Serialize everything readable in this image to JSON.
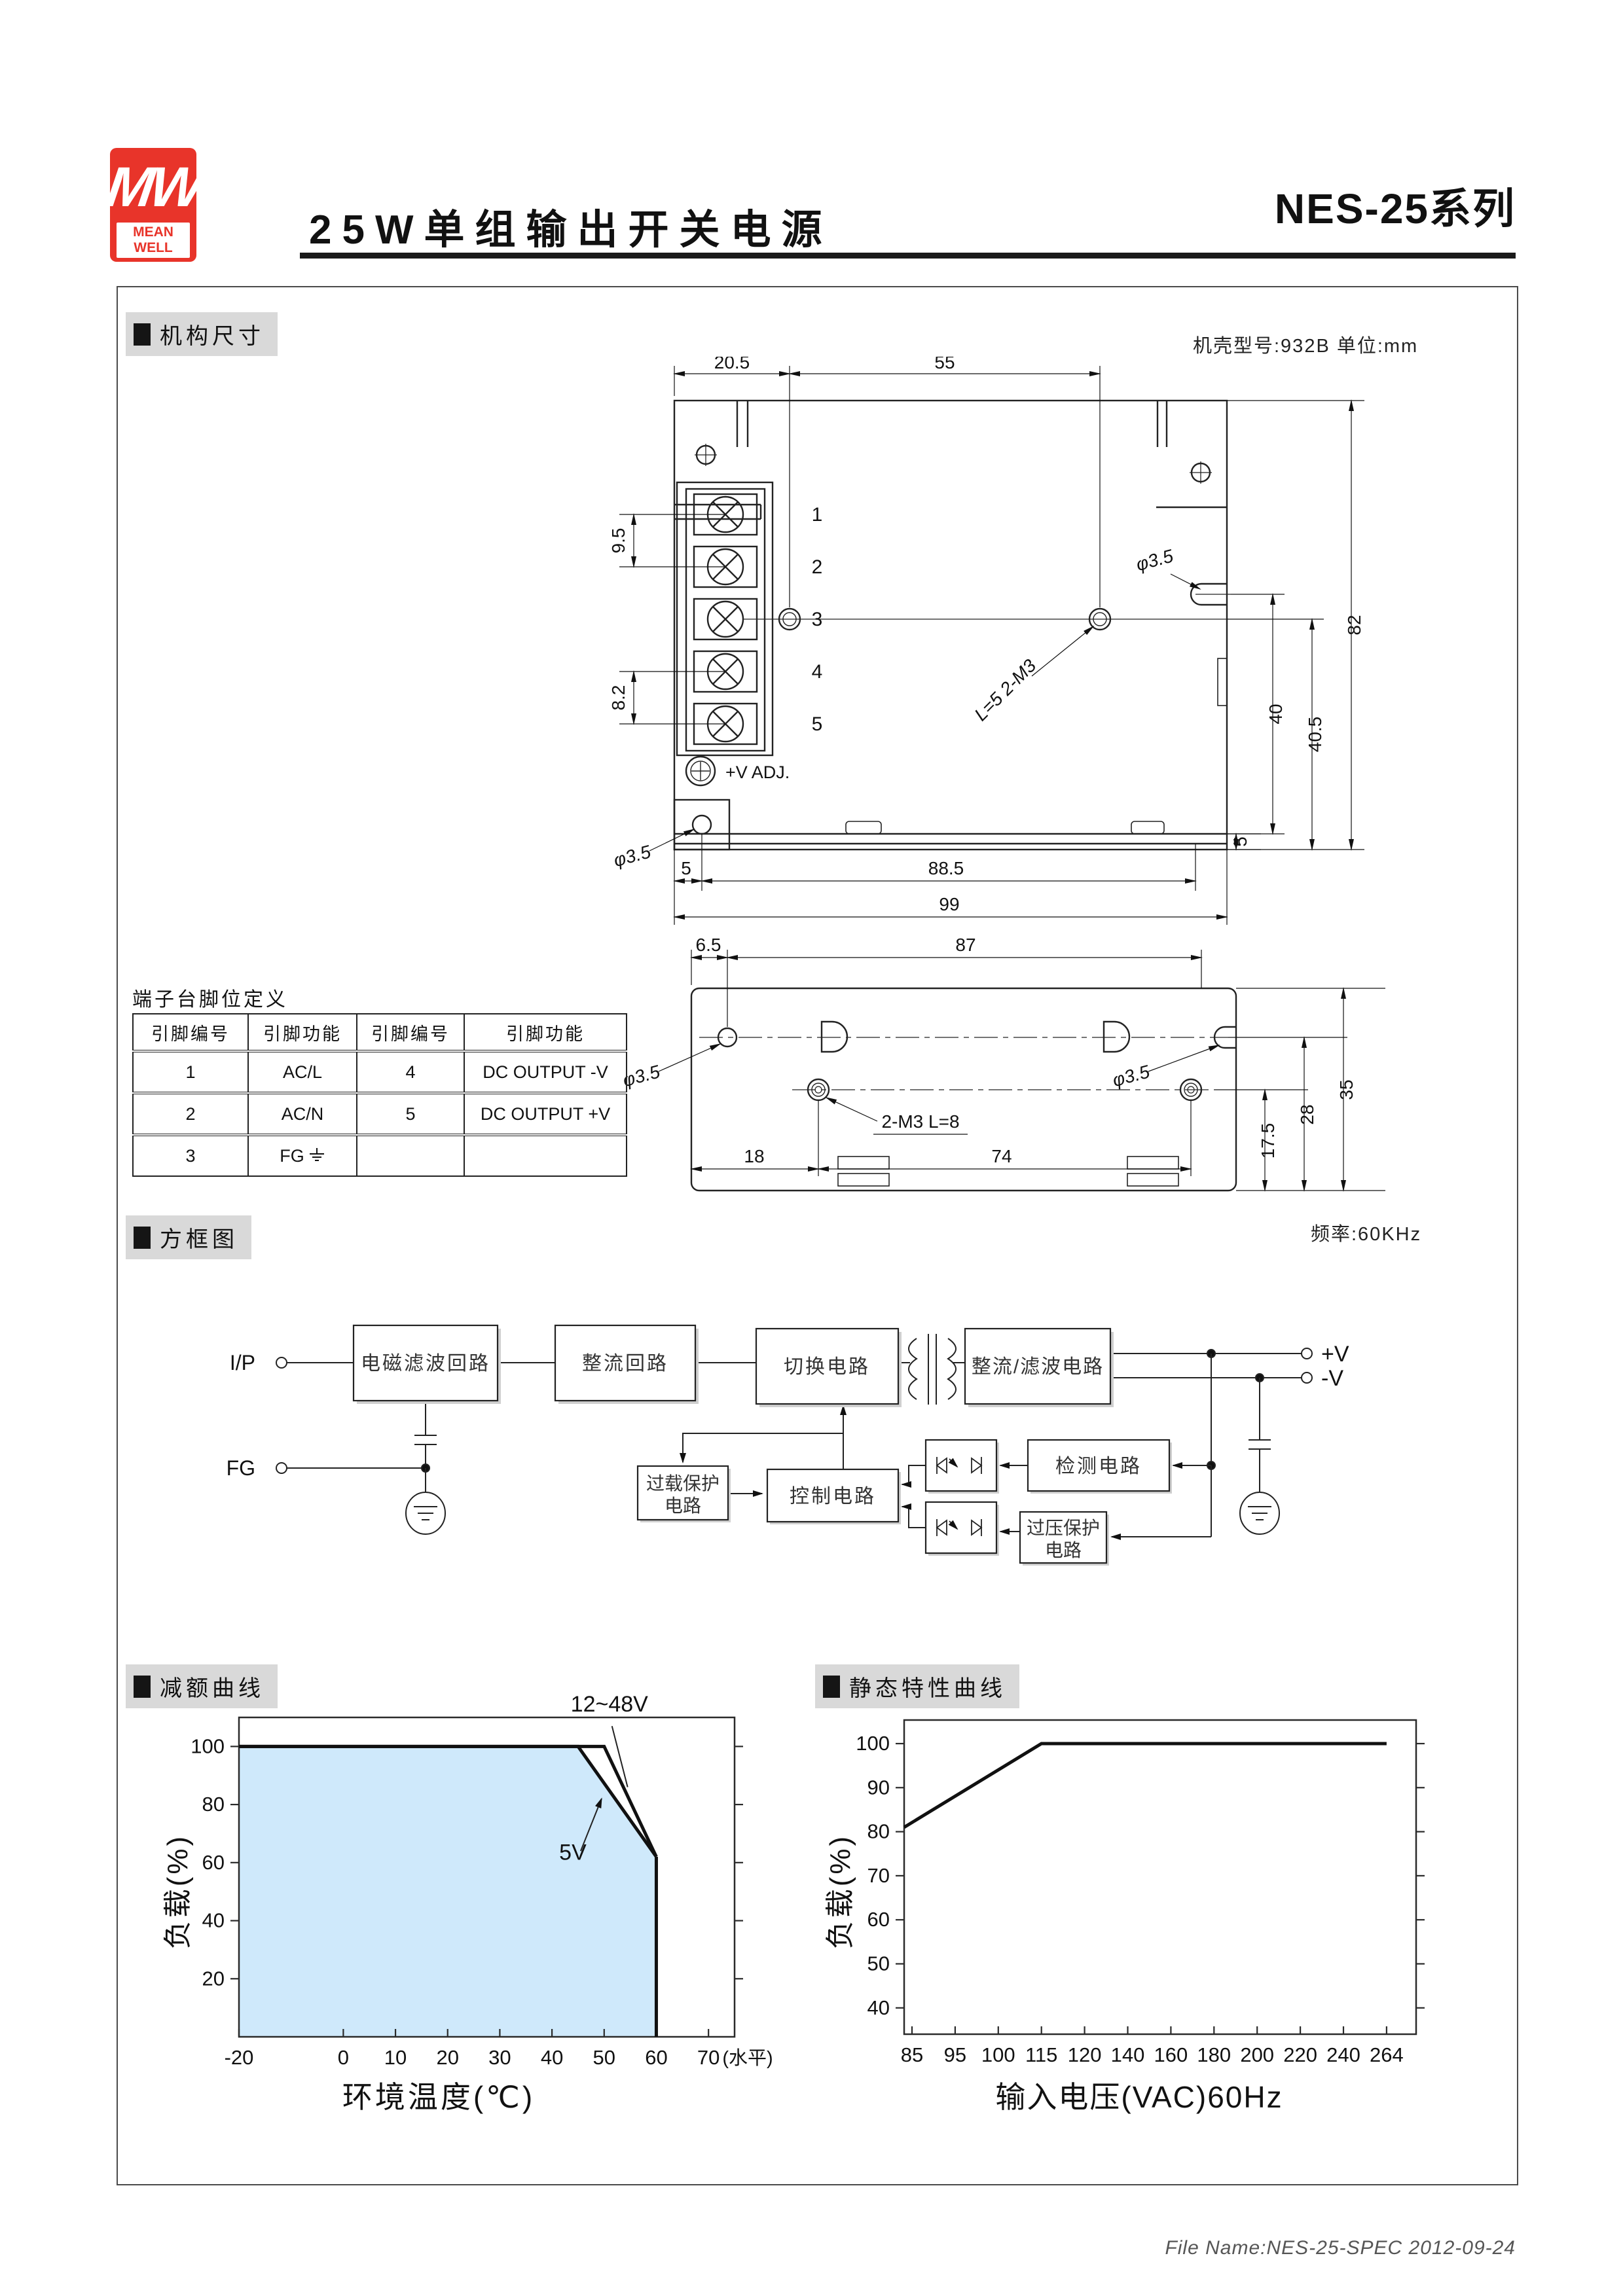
{
  "header": {
    "logo_mw": "MW",
    "logo_name": "MEAN WELL",
    "title": "25W单组输出开关电源",
    "series": "NES-25系列"
  },
  "sections": {
    "mech": "机构尺寸",
    "block": "方框图",
    "derating": "减额曲线",
    "static": "静态特性曲线"
  },
  "notes": {
    "case": "机壳型号:932B  单位:mm",
    "freq": "频率:60KHz"
  },
  "front": {
    "dim_205": "20.5",
    "dim_55": "55",
    "dim_95": "9.5",
    "dim_82": "8.2",
    "t1": "1",
    "t2": "2",
    "t3": "3",
    "t4": "4",
    "t5": "5",
    "phi_a": "φ3.5",
    "phi_b": "φ3.5",
    "m3": "L=5  2-M3",
    "vadj": "+V ADJ.",
    "dim_h82": "82",
    "dim_40": "40",
    "dim_405": "40.5",
    "dim_5r": "5",
    "dim_5b": "5",
    "dim_885": "88.5",
    "dim_99": "99"
  },
  "bottomview": {
    "dim_65": "6.5",
    "dim_87": "87",
    "phi_a": "φ3.5",
    "phi_b": "φ3.5",
    "m3": "2-M3  L=8",
    "dim_18": "18",
    "dim_74": "74",
    "dim_175": "17.5",
    "dim_28": "28",
    "dim_35": "35"
  },
  "pin_table": {
    "title": "端子台脚位定义",
    "headers": [
      "引脚编号",
      "引脚功能",
      "引脚编号",
      "引脚功能"
    ],
    "rows": [
      [
        "1",
        "AC/L",
        "4",
        "DC OUTPUT -V"
      ],
      [
        "2",
        "AC/N",
        "5",
        "DC OUTPUT +V"
      ],
      [
        "3",
        "FG",
        "",
        ""
      ]
    ]
  },
  "block": {
    "ip": "I/P",
    "fg": "FG",
    "emi": "电磁滤波回路",
    "rectifier": "整流回路",
    "sw": "切换电路",
    "outrect": "整流/滤波电路",
    "vplus": "+V",
    "vminus": "-V",
    "olp1": "过载保护",
    "olp2": "电路",
    "ctrl": "控制电路",
    "det": "检测电路",
    "ovp1": "过压保护",
    "ovp2": "电路"
  },
  "chart_data": [
    {
      "type": "line",
      "title": "减额曲线",
      "xlabel": "环境温度(℃)",
      "ylabel": "负载(%)",
      "x_ticks": [
        -20,
        0,
        10,
        20,
        30,
        40,
        50,
        60,
        70
      ],
      "x_end_label": "(水平)",
      "y_ticks": [
        20,
        40,
        60,
        80,
        100
      ],
      "xlim": [
        -20,
        75
      ],
      "ylim": [
        0,
        110
      ],
      "grid": false,
      "series": [
        {
          "name": "12~48V",
          "points": [
            [
              -20,
              100
            ],
            [
              50,
              100
            ],
            [
              60,
              62
            ]
          ]
        },
        {
          "name": "5V",
          "points": [
            [
              -20,
              100
            ],
            [
              45,
              100
            ],
            [
              60,
              62
            ]
          ]
        }
      ],
      "drop_x": 60,
      "fill_under": "5V",
      "fill_color": "#cfe9fb",
      "annotations": [
        {
          "text": "12~48V",
          "tx": 51,
          "ty": 112,
          "line": [
            51.5,
            107,
            54.5,
            86
          ],
          "arrow": false
        },
        {
          "text": "5V",
          "tx": 44,
          "ty": 61,
          "line": [
            45.5,
            64,
            49.5,
            82
          ],
          "arrow": true
        }
      ]
    },
    {
      "type": "line",
      "title": "静态特性曲线",
      "xlabel": "输入电压(VAC)60Hz",
      "ylabel": "负载(%)",
      "x_tick_labels": [
        "85",
        "95",
        "100",
        "115",
        "120",
        "140",
        "160",
        "180",
        "200",
        "220",
        "240",
        "264"
      ],
      "y_ticks": [
        40,
        50,
        60,
        70,
        80,
        90,
        100
      ],
      "grid": false,
      "series": [
        {
          "name": "负载",
          "points_idx": [
            [
              -0.2,
              81
            ],
            [
              3,
              100
            ],
            [
              11,
              100
            ]
          ]
        }
      ]
    }
  ],
  "footer": {
    "file": "File Name:NES-25-SPEC  2012-09-24"
  }
}
